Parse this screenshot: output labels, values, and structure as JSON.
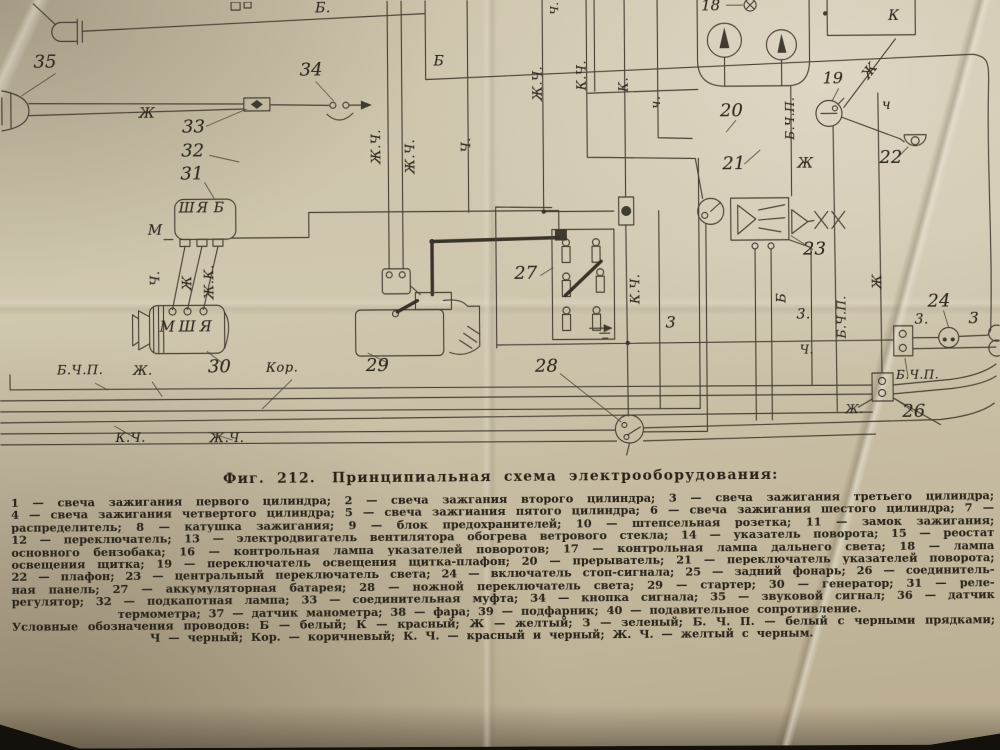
{
  "figure": {
    "caption_prefix": "Фиг. 212.",
    "caption_text": "Принципиальная схема электрооборудования:"
  },
  "legend": {
    "lines": [
      "1 — свеча зажигания первого цилиндра; 2 — свеча зажгания второго цилиндра; 3 — свеча зажигания третьего цилиндра;",
      "4 — свеча зажигания четвертого цилиндра; 5 — свеча зажгиания пятого цилиндра; 6 — свеча зажигания шестого цилиндра; 7 —",
      "распределитель; 8 — катушка зажигания; 9 — блок предохранителей; 10 — штепсельная розетка; 11 — замок зажигания;",
      "12 — переключатель; 13 — электродвигатель вентилятора обогрева ветрового стекла; 14 — указатель поворота; 15 — реостат",
      "основного бензобака; 16 — контрольная лампа указателей поворотов; 17 — контрольная лампа дальнего света; 18 — лампа",
      "освещения щитка; 19 — переключатель освещения щитка-плафон; 20 — прерыватель; 21 — переключатель указателей поворота;",
      "22 — плафон; 23 — центральный переключатель света; 24 — включатель стоп-сигнала; 25 — задний фонарь; 26 — соединитель-",
      "ная панель; 27 — аккумуляторная батарея; 28 — ножной переключатель света; 29 — стартер; 30 — генератор; 31 — реле-",
      "регулятор; 32 — подкапотная лампа; 33 — соединительная муфта; 34 — кнопка сигнала; 35 — звуковой сигнал; 36 — датчик",
      "термометра; 37 — датчик манометра; 38 — фара; 39 — подфарник; 40 — подавительное сопротивление.",
      "Условные обозначения проводов: Б — белый; К — красный; Ж — желтый; З — зеленый; Б. Ч. П. — белый с черными прядками;",
      "Ч — черный; Кор. — коричневый; К. Ч. — красный и черный; Ж. Ч. — желтый с черным."
    ]
  },
  "diagram": {
    "ink_color": "#3e372b",
    "paper_color": "#cbc1a8",
    "labels": [
      {
        "n": "component-number-35",
        "t": "35",
        "x": 36,
        "y": 50,
        "c": "num"
      },
      {
        "n": "component-number-34",
        "t": "34",
        "x": 302,
        "y": 60,
        "c": "num"
      },
      {
        "n": "component-number-33",
        "t": "33",
        "x": 184,
        "y": 116,
        "c": "num"
      },
      {
        "n": "component-number-32",
        "t": "32",
        "x": 183,
        "y": 140,
        "c": "num"
      },
      {
        "n": "component-number-31",
        "t": "31",
        "x": 182,
        "y": 163,
        "c": "num"
      },
      {
        "n": "component-number-30",
        "t": "30",
        "x": 208,
        "y": 356,
        "c": "num"
      },
      {
        "n": "component-number-29",
        "t": "29",
        "x": 366,
        "y": 356,
        "c": "num"
      },
      {
        "n": "component-number-28",
        "t": "28",
        "x": 535,
        "y": 358,
        "c": "num"
      },
      {
        "n": "component-number-27",
        "t": "27",
        "x": 515,
        "y": 265,
        "c": "num"
      },
      {
        "n": "component-number-26",
        "t": "26",
        "x": 902,
        "y": 406,
        "c": "num"
      },
      {
        "n": "component-number-24",
        "t": "24",
        "x": 928,
        "y": 296,
        "c": "num"
      },
      {
        "n": "component-number-23",
        "t": "23",
        "x": 804,
        "y": 243,
        "c": "num"
      },
      {
        "n": "component-number-22",
        "t": "22",
        "x": 881,
        "y": 152,
        "c": "num"
      },
      {
        "n": "component-number-21",
        "t": "21",
        "x": 724,
        "y": 157,
        "c": "num"
      },
      {
        "n": "component-number-20",
        "t": "20",
        "x": 722,
        "y": 104,
        "c": "num"
      },
      {
        "n": "component-number-19",
        "t": "19",
        "x": 825,
        "y": 73,
        "c": "num",
        "s": 16
      },
      {
        "n": "component-number-18",
        "t": "18",
        "x": 704,
        "y": 0,
        "c": "num",
        "s": 15
      },
      {
        "n": "wire-label-white-top",
        "t": "Б.",
        "x": 318,
        "y": 0,
        "c": "wire"
      },
      {
        "n": "wire-label-white-2",
        "t": "Б",
        "x": 436,
        "y": 54,
        "c": "wire"
      },
      {
        "n": "wire-label-yellow-horn",
        "t": "Ж",
        "x": 141,
        "y": 104,
        "c": "wire"
      },
      {
        "n": "wire-label-red-box",
        "t": "К",
        "x": 891,
        "y": 12,
        "c": "wire"
      },
      {
        "n": "wire-label-black-dome",
        "t": "ч",
        "x": 884,
        "y": 101,
        "c": "wire"
      },
      {
        "n": "wire-label-yellow-mid",
        "t": "Ж",
        "x": 799,
        "y": 159,
        "c": "wire"
      },
      {
        "n": "wire-label-green-1",
        "t": "3",
        "x": 666,
        "y": 316,
        "c": "wire",
        "s": 16
      },
      {
        "n": "wire-label-green-2",
        "t": "3.",
        "x": 797,
        "y": 310,
        "c": "wire"
      },
      {
        "n": "wire-label-black-vert",
        "t": "Ч.",
        "x": 800,
        "y": 346,
        "c": "wire",
        "s": 12
      },
      {
        "n": "wire-label-green-3",
        "t": "3.",
        "x": 915,
        "y": 316,
        "c": "wire"
      },
      {
        "n": "wire-label-green-4",
        "t": "3",
        "x": 969,
        "y": 314,
        "c": "wire",
        "s": 16
      },
      {
        "n": "bus-label-bchp-left",
        "t": "Б.Ч.П.",
        "x": 57,
        "y": 361,
        "c": "wire",
        "s": 13
      },
      {
        "n": "bus-label-yellow-left",
        "t": "Ж.",
        "x": 133,
        "y": 362,
        "c": "wire",
        "s": 13
      },
      {
        "n": "bus-label-brown",
        "t": "Кор.",
        "x": 266,
        "y": 360,
        "c": "wire",
        "s": 13
      },
      {
        "n": "bus-label-redblack",
        "t": "К.Ч.",
        "x": 115,
        "y": 429,
        "c": "wire",
        "s": 13
      },
      {
        "n": "bus-label-yellowblack",
        "t": "Ж.Ч.",
        "x": 209,
        "y": 430,
        "c": "wire",
        "s": 13
      },
      {
        "n": "bus-label-bchp-right",
        "t": "Б.Ч.П.",
        "x": 896,
        "y": 372,
        "c": "wire",
        "s": 12
      },
      {
        "n": "bus-label-yellow-right",
        "t": "Ж.",
        "x": 845,
        "y": 406,
        "c": "wire",
        "s": 12
      },
      {
        "n": "wire-label-yellowblack-v1",
        "t": "Ж.Ч.",
        "x": 372,
        "y": 163,
        "c": "wire rot",
        "s": 13
      },
      {
        "n": "wire-label-yellowblack-v2",
        "t": "Ж.Ч.",
        "x": 406,
        "y": 173,
        "c": "wire rot",
        "s": 13
      },
      {
        "n": "wire-label-black-v1",
        "t": "Ч.",
        "x": 462,
        "y": 152,
        "c": "wire rot",
        "s": 13
      },
      {
        "n": "wire-label-black-top",
        "t": "Ч.",
        "x": 552,
        "y": 15,
        "c": "wire rot",
        "s": 11
      },
      {
        "n": "wire-label-yellowblack-v3",
        "t": "Ж.Ч.",
        "x": 534,
        "y": 101,
        "c": "wire rot",
        "s": 13
      },
      {
        "n": "wire-label-redblack-v1",
        "t": "К.Ч.",
        "x": 578,
        "y": 91,
        "c": "wire rot",
        "s": 13
      },
      {
        "n": "wire-label-red-v",
        "t": "К.",
        "x": 620,
        "y": 93,
        "c": "wire rot",
        "s": 13
      },
      {
        "n": "wire-label-black-v2",
        "t": "ч.",
        "x": 652,
        "y": 110,
        "c": "wire rot",
        "s": 13
      },
      {
        "n": "wire-label-bchp-v1",
        "t": "Б.Ч.П.",
        "x": 786,
        "y": 142,
        "c": "wire rot",
        "s": 12
      },
      {
        "n": "wire-label-yellow-diag",
        "t": "Ж",
        "x": 862,
        "y": 76,
        "c": "wire",
        "r": -52
      },
      {
        "n": "wire-label-black-gen",
        "t": "Ч.",
        "x": 150,
        "y": 283,
        "c": "wire rot",
        "s": 13
      },
      {
        "n": "wire-label-yellow-gen",
        "t": "Ж",
        "x": 182,
        "y": 288,
        "c": "wire rot",
        "s": 13
      },
      {
        "n": "wire-label-yellowred-gen",
        "t": "Ж.К.",
        "x": 204,
        "y": 297,
        "c": "wire rot",
        "s": 13
      },
      {
        "n": "wire-label-redblack-v2",
        "t": "К.Ч.",
        "x": 630,
        "y": 305,
        "c": "wire rot",
        "s": 13
      },
      {
        "n": "wire-label-white-v",
        "t": "Б",
        "x": 776,
        "y": 305,
        "c": "wire rot",
        "s": 13
      },
      {
        "n": "wire-label-bchp-v2",
        "t": "Б.Ч.П.",
        "x": 836,
        "y": 341,
        "c": "wire rot",
        "s": 12
      },
      {
        "n": "wire-label-yellow-v",
        "t": "Ж",
        "x": 872,
        "y": 292,
        "c": "wire rot",
        "s": 13
      },
      {
        "n": "relay-terminal-sh",
        "t": "Ш",
        "x": 180,
        "y": 199,
        "c": "term"
      },
      {
        "n": "relay-terminal-ya",
        "t": "Я",
        "x": 198,
        "y": 199,
        "c": "term"
      },
      {
        "n": "relay-terminal-b",
        "t": "Б",
        "x": 215,
        "y": 199,
        "c": "term"
      },
      {
        "n": "relay-terminal-m",
        "t": "М",
        "x": 149,
        "y": 221,
        "c": "term"
      },
      {
        "n": "generator-terminal-m",
        "t": "М",
        "x": 160,
        "y": 317,
        "c": "term",
        "s": 15
      },
      {
        "n": "generator-terminal-sh",
        "t": "Ш",
        "x": 179,
        "y": 317,
        "c": "term",
        "s": 15
      },
      {
        "n": "generator-terminal-ya",
        "t": "Я",
        "x": 200,
        "y": 317,
        "c": "term",
        "s": 15
      }
    ]
  }
}
